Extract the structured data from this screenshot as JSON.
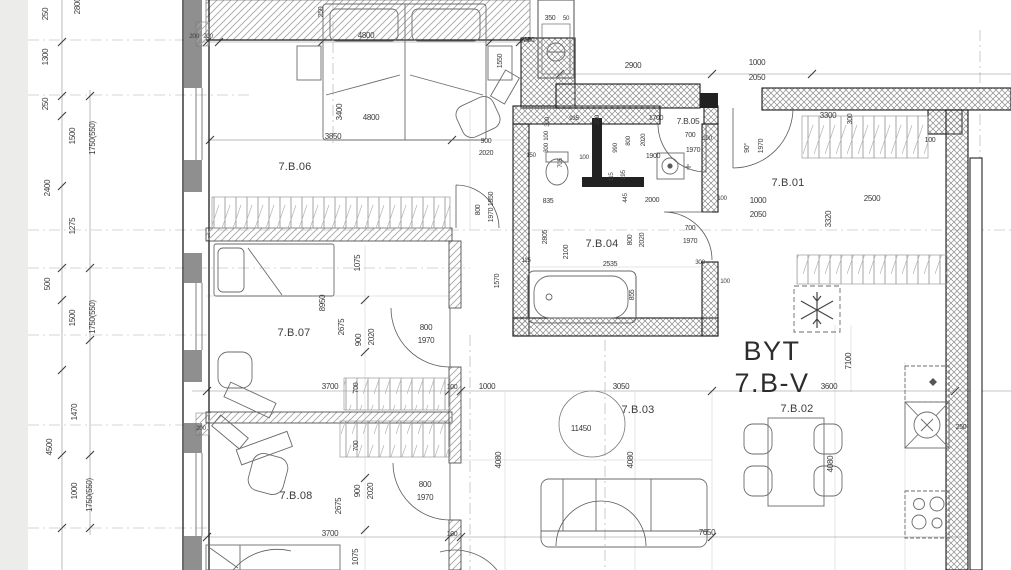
{
  "title": {
    "line1": "BYT",
    "line2": "7.B-V"
  },
  "rooms": {
    "r01": "7.B.01",
    "r02": "7.B.02",
    "r03": "7.B.03",
    "r04": "7.B.04",
    "r05": "7.B.05",
    "r06": "7.B.06",
    "r07": "7.B.07",
    "r08": "7.B.08"
  },
  "dims_left": [
    "250",
    "2800",
    "1300",
    "250",
    "1500",
    "1750(550)",
    "2400",
    "1275",
    "500",
    "1500",
    "1750(550)",
    "1470",
    "4500",
    "1000",
    "1750(550)",
    "1050"
  ],
  "dims_top": [
    "200",
    "200",
    "250",
    "4800",
    "350",
    "50",
    "250",
    "2900",
    "1000",
    "2050"
  ],
  "room06": [
    "3400",
    "4800",
    "3850",
    "900",
    "2020",
    "1550",
    "800",
    "1970 1850"
  ],
  "bath_hall": [
    "935",
    "300",
    "200",
    "150",
    "100",
    "300",
    "705",
    "100",
    "835",
    "115",
    "195",
    "445",
    "2000",
    "100"
  ],
  "room05": [
    "1700",
    "990",
    "800",
    "2020",
    "1900",
    "700",
    "100",
    "1970"
  ],
  "room04": [
    "2805",
    "2100",
    "800",
    "2020",
    "700",
    "1970",
    "2535",
    "115",
    "1570",
    "855",
    "300",
    "100"
  ],
  "room01": [
    "90°",
    "1970",
    "3300",
    "300",
    "100",
    "1000",
    "2050",
    "2500",
    "3320"
  ],
  "room07": [
    "1075",
    "8950",
    "2675",
    "900",
    "2020",
    "800",
    "1970",
    "3700",
    "700",
    "100",
    "200"
  ],
  "room08": [
    "700",
    "900",
    "2020",
    "2675",
    "800",
    "1970",
    "3700",
    "100",
    "1075"
  ],
  "living": [
    "1000",
    "3050",
    "11450",
    "4080",
    "4080",
    "7650"
  ],
  "kitchen": [
    "3600",
    "7100",
    "4080",
    "250"
  ],
  "colors": {
    "wall_gray": "#8f8f8f",
    "line": "#3b3b3b",
    "hatch": "#9a9a9a"
  }
}
